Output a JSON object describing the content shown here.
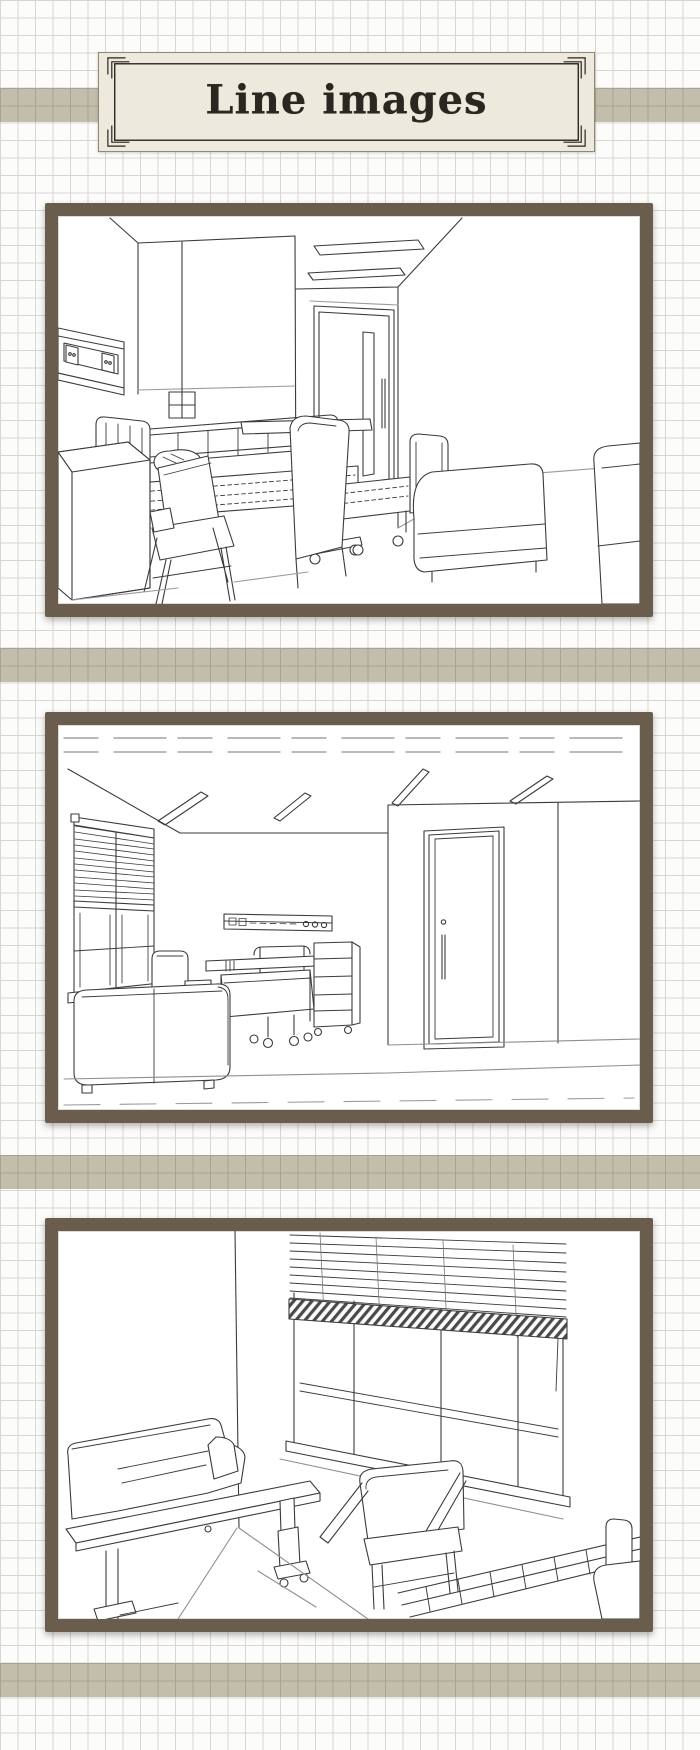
{
  "banner": {
    "title": "Line images"
  },
  "colors": {
    "frame_brown": "#6b5d4d",
    "stripe_tan": "#c3bdac",
    "banner_cream": "#edeadd",
    "grid_line": "#d7d6d3",
    "ink": "#3b3b3b",
    "paper": "#fcfcfb"
  },
  "gallery": {
    "images": [
      {
        "name": "hospital-room-line-drawing-1",
        "description": "Line drawing of a hospital room: two beds with side rails, wooden armchair, tall-back chair, overbed table on casters, bedside cabinet, wall console, door and sofa"
      },
      {
        "name": "hospital-room-line-drawing-2",
        "description": "Line drawing of a hospital room: window with venetian blind, ceiling light panels, headwall outlet rail, bed with overbed table, supply cart, sofa and entrance door"
      },
      {
        "name": "hospital-room-line-drawing-3",
        "description": "Line drawing of a hospital room corner: large window with half-raised venetian blind, sofa with long overbed table, wooden armchair and hospital bed rail"
      }
    ]
  }
}
